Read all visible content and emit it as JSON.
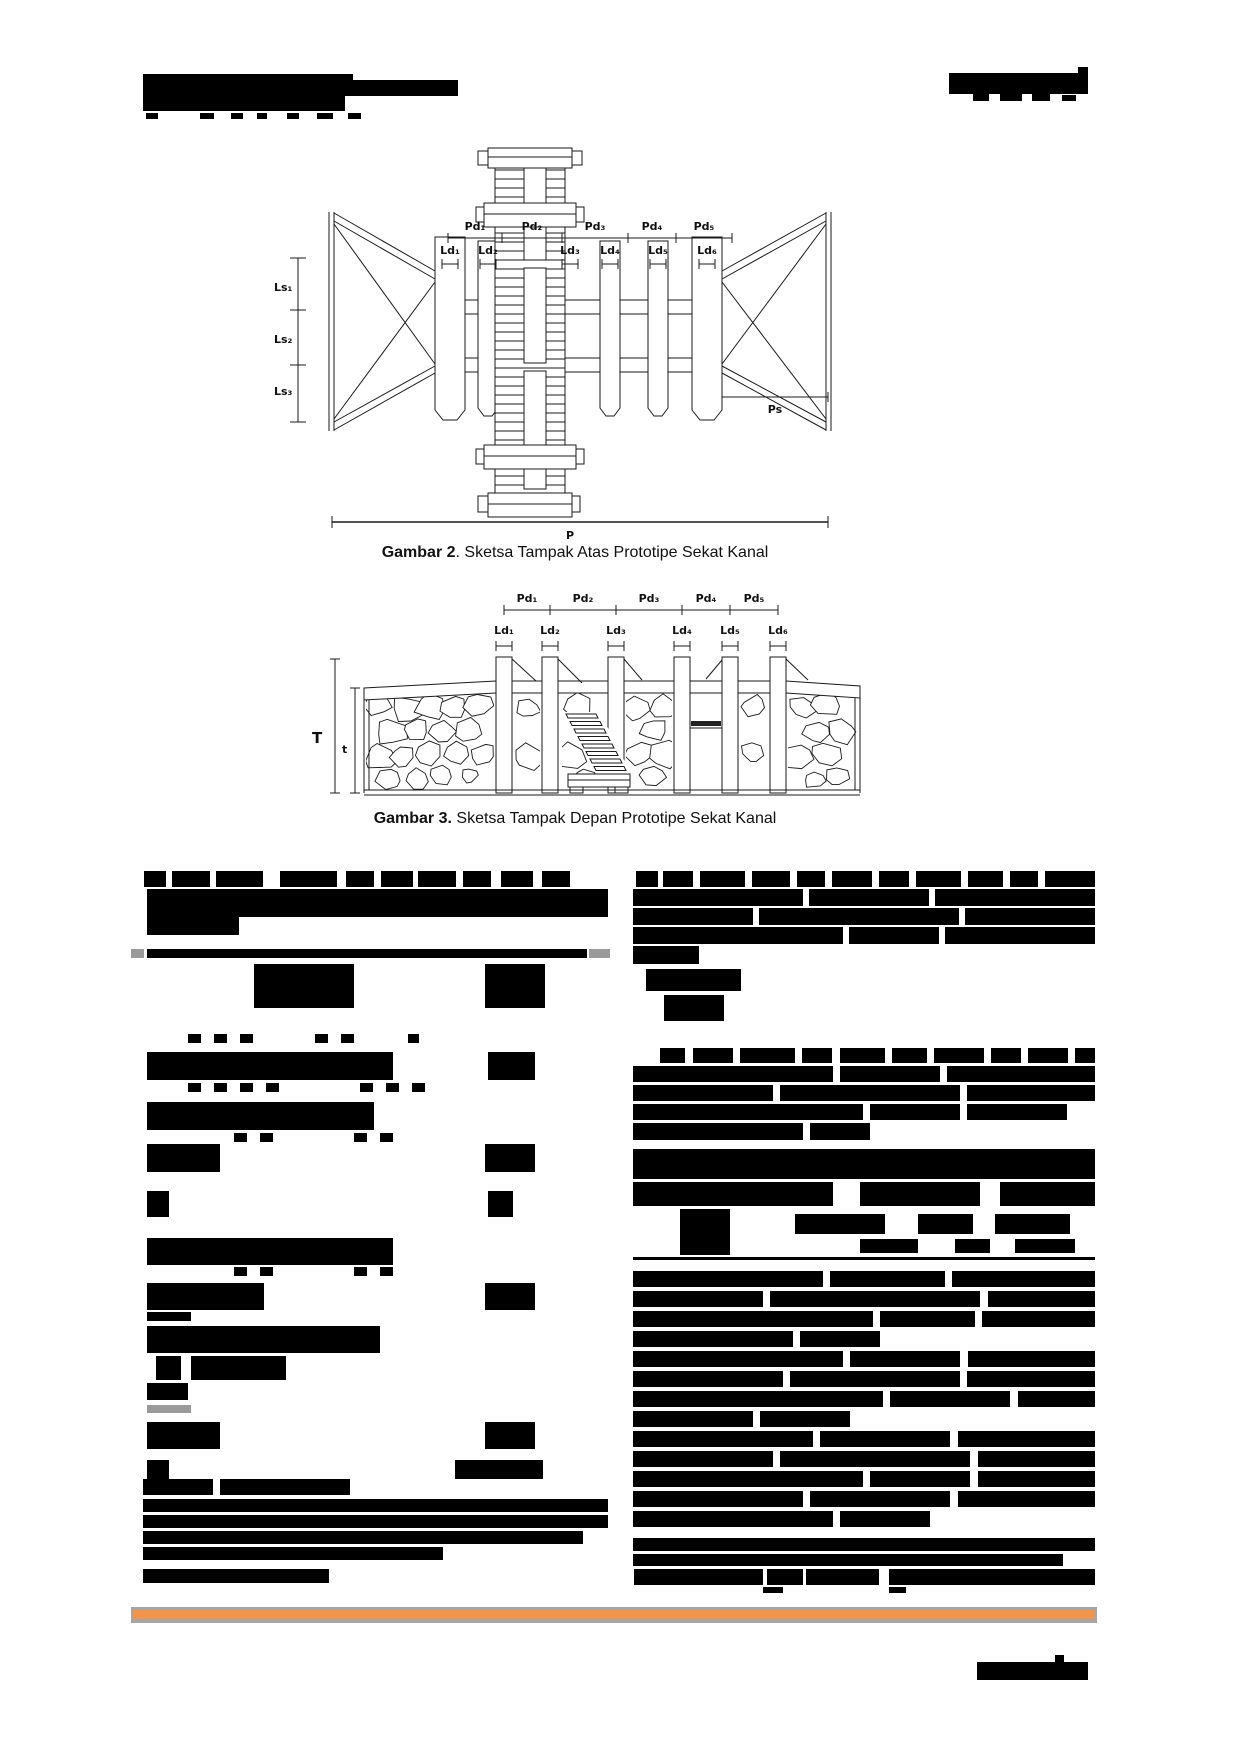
{
  "page": {
    "width": 1240,
    "height": 1754,
    "background": "#ffffff"
  },
  "figures": [
    {
      "id": "gambar-2",
      "caption_bold": "Gambar 2",
      "caption_rest": ". Sketsa Tampak Atas Prototipe Sekat Kanal",
      "labels": {
        "pd": [
          "Pd₁",
          "Pd₂",
          "Pd₃",
          "Pd₄",
          "Pd₅"
        ],
        "ld": [
          "Ld₁",
          "Ld₂",
          "Ld₃",
          "Ld₄",
          "Ld₅",
          "Ld₆"
        ],
        "ls": [
          "Ls₁",
          "Ls₂",
          "Ls₃"
        ],
        "ps": "Ps",
        "p": "P"
      }
    },
    {
      "id": "gambar-3",
      "caption_bold": "Gambar 3.",
      "caption_rest": " Sketsa Tampak Depan Prototipe Sekat Kanal",
      "labels": {
        "pd": [
          "Pd₁",
          "Pd₂",
          "Pd₃",
          "Pd₄",
          "Pd₅"
        ],
        "ld": [
          "Ld₁",
          "Ld₂",
          "Ld₃",
          "Ld₄",
          "Ld₅",
          "Ld₆"
        ],
        "T": "T",
        "t": "t"
      }
    }
  ],
  "redactions": {
    "color": "#000000",
    "gray": "#9a9a9a",
    "header": [
      [
        143,
        74,
        210,
        21
      ],
      [
        308,
        80,
        150,
        16
      ],
      [
        143,
        93,
        202,
        18
      ],
      [
        146,
        113,
        12,
        6
      ],
      [
        200,
        113,
        14,
        6
      ],
      [
        231,
        113,
        12,
        6
      ],
      [
        257,
        113,
        10,
        6
      ],
      [
        287,
        113,
        12,
        6
      ],
      [
        317,
        113,
        16,
        6
      ],
      [
        348,
        113,
        13,
        6
      ],
      [
        949,
        73,
        139,
        21
      ],
      [
        1078,
        67,
        10,
        8
      ],
      [
        973,
        94,
        16,
        7
      ],
      [
        1000,
        94,
        22,
        7
      ],
      [
        1032,
        94,
        18,
        7
      ],
      [
        1062,
        95,
        14,
        6
      ]
    ],
    "body": [
      [
        144,
        871,
        22,
        16
      ],
      [
        172,
        871,
        38,
        16
      ],
      [
        216,
        871,
        47,
        16
      ],
      [
        280,
        871,
        57,
        16
      ],
      [
        346,
        871,
        28,
        16
      ],
      [
        381,
        871,
        32,
        16
      ],
      [
        418,
        871,
        38,
        16
      ],
      [
        463,
        871,
        28,
        16
      ],
      [
        501,
        871,
        32,
        16
      ],
      [
        542,
        871,
        28,
        16
      ],
      [
        147,
        889,
        461,
        28
      ],
      [
        147,
        917,
        92,
        18
      ],
      [
        131,
        949,
        13,
        9,
        "g"
      ],
      [
        147,
        949,
        440,
        9
      ],
      [
        589,
        949,
        21,
        9,
        "g"
      ],
      [
        254,
        964,
        100,
        44
      ],
      [
        485,
        964,
        60,
        44
      ],
      [
        188,
        1034,
        13,
        9
      ],
      [
        214,
        1034,
        13,
        9
      ],
      [
        240,
        1034,
        13,
        9
      ],
      [
        315,
        1034,
        13,
        9
      ],
      [
        341,
        1034,
        13,
        9
      ],
      [
        408,
        1034,
        11,
        9
      ],
      [
        147,
        1052,
        246,
        28
      ],
      [
        488,
        1052,
        47,
        28
      ],
      [
        188,
        1083,
        13,
        9
      ],
      [
        214,
        1083,
        13,
        9
      ],
      [
        240,
        1083,
        13,
        9
      ],
      [
        266,
        1083,
        13,
        9
      ],
      [
        360,
        1083,
        13,
        9
      ],
      [
        386,
        1083,
        13,
        9
      ],
      [
        412,
        1083,
        13,
        9
      ],
      [
        147,
        1102,
        227,
        28
      ],
      [
        234,
        1133,
        13,
        9
      ],
      [
        260,
        1133,
        13,
        9
      ],
      [
        354,
        1133,
        13,
        9
      ],
      [
        380,
        1133,
        13,
        9
      ],
      [
        147,
        1144,
        73,
        28
      ],
      [
        485,
        1144,
        50,
        28
      ],
      [
        147,
        1191,
        22,
        26
      ],
      [
        488,
        1191,
        25,
        26
      ],
      [
        147,
        1238,
        246,
        27
      ],
      [
        234,
        1267,
        13,
        9
      ],
      [
        260,
        1267,
        13,
        9
      ],
      [
        354,
        1267,
        13,
        9
      ],
      [
        380,
        1267,
        13,
        9
      ],
      [
        147,
        1283,
        117,
        27
      ],
      [
        485,
        1283,
        50,
        27
      ],
      [
        147,
        1312,
        44,
        9
      ],
      [
        147,
        1326,
        233,
        27
      ],
      [
        156,
        1356,
        25,
        24
      ],
      [
        191,
        1356,
        95,
        24
      ],
      [
        147,
        1383,
        41,
        17
      ],
      [
        147,
        1405,
        44,
        8,
        "g"
      ],
      [
        147,
        1422,
        73,
        27
      ],
      [
        485,
        1422,
        50,
        27
      ],
      [
        147,
        1460,
        22,
        19
      ],
      [
        455,
        1460,
        88,
        19
      ],
      [
        143,
        1479,
        70,
        16
      ],
      [
        220,
        1479,
        130,
        16
      ],
      [
        143,
        1499,
        465,
        13
      ],
      [
        143,
        1515,
        465,
        13
      ],
      [
        143,
        1531,
        440,
        13
      ],
      [
        143,
        1547,
        300,
        13
      ],
      [
        143,
        1569,
        186,
        14
      ],
      [
        636,
        871,
        22,
        16
      ],
      [
        663,
        871,
        30,
        16
      ],
      [
        700,
        871,
        45,
        16
      ],
      [
        752,
        871,
        38,
        16
      ],
      [
        797,
        871,
        28,
        16
      ],
      [
        832,
        871,
        40,
        16
      ],
      [
        879,
        871,
        30,
        16
      ],
      [
        916,
        871,
        45,
        16
      ],
      [
        968,
        871,
        35,
        16
      ],
      [
        1010,
        871,
        28,
        16
      ],
      [
        1045,
        871,
        50,
        16
      ],
      [
        633,
        889,
        170,
        17
      ],
      [
        809,
        889,
        120,
        17
      ],
      [
        935,
        889,
        160,
        17
      ],
      [
        633,
        908,
        120,
        17
      ],
      [
        759,
        908,
        200,
        17
      ],
      [
        965,
        908,
        130,
        17
      ],
      [
        633,
        927,
        210,
        17
      ],
      [
        849,
        927,
        90,
        17
      ],
      [
        945,
        927,
        150,
        17
      ],
      [
        633,
        946,
        66,
        18
      ],
      [
        646,
        969,
        95,
        22
      ],
      [
        664,
        995,
        60,
        26
      ],
      [
        660,
        1048,
        25,
        15
      ],
      [
        693,
        1048,
        40,
        15
      ],
      [
        740,
        1048,
        55,
        15
      ],
      [
        802,
        1048,
        30,
        15
      ],
      [
        840,
        1048,
        45,
        15
      ],
      [
        892,
        1048,
        35,
        15
      ],
      [
        934,
        1048,
        50,
        15
      ],
      [
        991,
        1048,
        30,
        15
      ],
      [
        1028,
        1048,
        40,
        15
      ],
      [
        1075,
        1048,
        20,
        15
      ],
      [
        633,
        1066,
        200,
        16
      ],
      [
        840,
        1066,
        100,
        16
      ],
      [
        947,
        1066,
        148,
        16
      ],
      [
        633,
        1085,
        140,
        16
      ],
      [
        780,
        1085,
        180,
        16
      ],
      [
        967,
        1085,
        128,
        16
      ],
      [
        633,
        1104,
        230,
        16
      ],
      [
        870,
        1104,
        90,
        16
      ],
      [
        967,
        1104,
        100,
        16
      ],
      [
        633,
        1123,
        170,
        17
      ],
      [
        810,
        1123,
        60,
        17
      ],
      [
        633,
        1149,
        462,
        30
      ],
      [
        633,
        1182,
        200,
        24
      ],
      [
        860,
        1182,
        120,
        24
      ],
      [
        1000,
        1182,
        95,
        24
      ],
      [
        680,
        1209,
        50,
        46
      ],
      [
        795,
        1214,
        90,
        20
      ],
      [
        918,
        1214,
        55,
        20
      ],
      [
        995,
        1214,
        75,
        20
      ],
      [
        860,
        1239,
        58,
        14
      ],
      [
        955,
        1239,
        35,
        14
      ],
      [
        1015,
        1239,
        60,
        14
      ],
      [
        633,
        1257,
        462,
        3
      ],
      [
        633,
        1271,
        190,
        16
      ],
      [
        830,
        1271,
        115,
        16
      ],
      [
        952,
        1271,
        143,
        16
      ],
      [
        633,
        1291,
        130,
        16
      ],
      [
        770,
        1291,
        210,
        16
      ],
      [
        988,
        1291,
        107,
        16
      ],
      [
        633,
        1311,
        240,
        16
      ],
      [
        880,
        1311,
        95,
        16
      ],
      [
        982,
        1311,
        113,
        16
      ],
      [
        633,
        1331,
        160,
        16
      ],
      [
        800,
        1331,
        80,
        16
      ],
      [
        633,
        1351,
        210,
        16
      ],
      [
        850,
        1351,
        110,
        16
      ],
      [
        968,
        1351,
        127,
        16
      ],
      [
        633,
        1371,
        150,
        16
      ],
      [
        790,
        1371,
        170,
        16
      ],
      [
        967,
        1371,
        128,
        16
      ],
      [
        633,
        1391,
        250,
        16
      ],
      [
        890,
        1391,
        120,
        16
      ],
      [
        1018,
        1391,
        77,
        16
      ],
      [
        633,
        1411,
        120,
        16
      ],
      [
        760,
        1411,
        90,
        16
      ],
      [
        633,
        1431,
        180,
        16
      ],
      [
        820,
        1431,
        130,
        16
      ],
      [
        958,
        1431,
        137,
        16
      ],
      [
        633,
        1451,
        140,
        16
      ],
      [
        780,
        1451,
        190,
        16
      ],
      [
        978,
        1451,
        117,
        16
      ],
      [
        633,
        1471,
        230,
        16
      ],
      [
        870,
        1471,
        100,
        16
      ],
      [
        978,
        1471,
        117,
        16
      ],
      [
        633,
        1491,
        170,
        16
      ],
      [
        810,
        1491,
        140,
        16
      ],
      [
        958,
        1491,
        137,
        16
      ],
      [
        633,
        1511,
        200,
        16
      ],
      [
        840,
        1511,
        90,
        16
      ],
      [
        633,
        1538,
        462,
        13
      ],
      [
        633,
        1554,
        430,
        12
      ],
      [
        634,
        1569,
        129,
        16
      ],
      [
        767,
        1569,
        36,
        16
      ],
      [
        806,
        1569,
        73,
        16
      ],
      [
        889,
        1569,
        206,
        16
      ],
      [
        763,
        1587,
        20,
        6
      ],
      [
        889,
        1587,
        17,
        6
      ]
    ],
    "bottom": [
      [
        977,
        1662,
        111,
        18
      ],
      [
        1055,
        1655,
        9,
        8
      ]
    ]
  },
  "footer": {
    "rule_gray": "#a6a6a6",
    "rule_orange": "#f2944a",
    "band": {
      "x": 131,
      "y": 1607,
      "w": 966,
      "h": 16
    }
  }
}
